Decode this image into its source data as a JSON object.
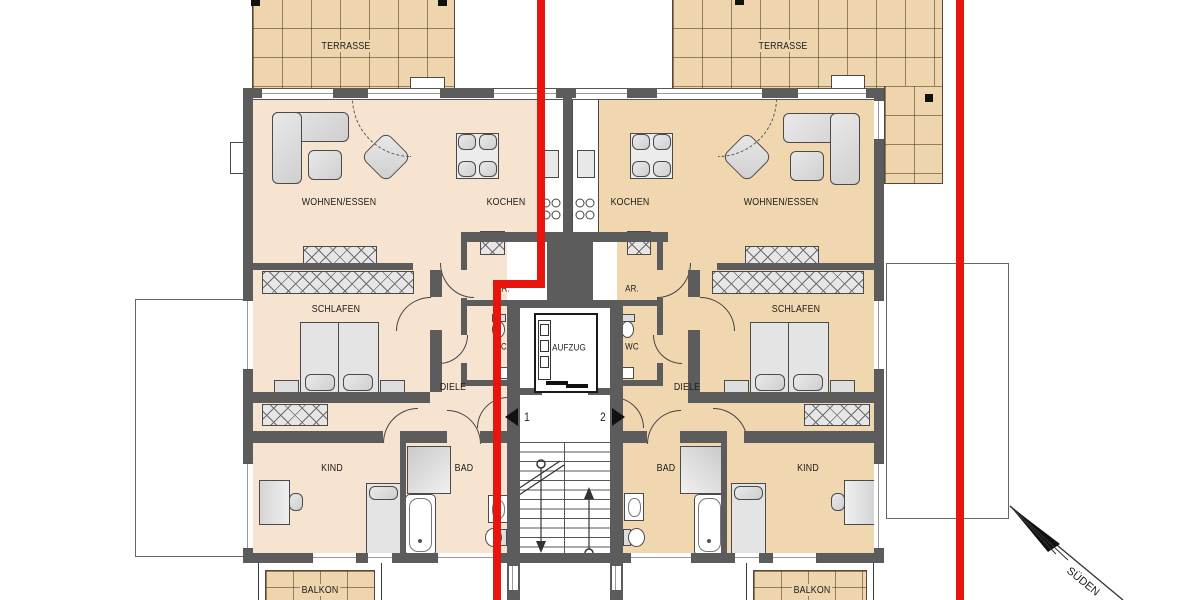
{
  "plan": {
    "type": "residential floor plan, two mirrored apartments with shared stair/elevator core",
    "orientation_arrow": "SÜDEN",
    "section_lines": {
      "count": 2,
      "color": "#e8150f"
    },
    "colors": {
      "left_unit_floor": "#f7e4d0",
      "right_unit_floor": "#f0d7af",
      "terrace_tile": "#eed5ae",
      "wall": "#5c5c5c",
      "section_line_red": "#e8150f",
      "background": "#ffffff"
    },
    "apartments": [
      {
        "marker": "1",
        "rooms": [
          "WOHNEN/ESSEN",
          "KOCHEN",
          "SCHLAFEN",
          "KIND",
          "BAD",
          "WC",
          "AR.",
          "DIELE"
        ],
        "outdoor": [
          "TERRASSE",
          "BALKON"
        ]
      },
      {
        "marker": "2",
        "rooms": [
          "WOHNEN/ESSEN",
          "KOCHEN",
          "SCHLAFEN",
          "KIND",
          "BAD",
          "WC",
          "AR.",
          "DIELE"
        ],
        "outdoor": [
          "TERRASSE",
          "BALKON"
        ]
      }
    ],
    "shared": [
      "AUFZUG",
      "stairwell"
    ]
  },
  "labels": {
    "terrasse_left": "TERRASSE",
    "terrasse_right": "TERRASSE",
    "wohnen_left": "WOHNEN/ESSEN",
    "wohnen_right": "WOHNEN/ESSEN",
    "kochen_left": "KOCHEN",
    "kochen_right": "KOCHEN",
    "schlafen_left": "SCHLAFEN",
    "schlafen_right": "SCHLAFEN",
    "ar_left": "AR.",
    "ar_right": "AR.",
    "wc_left": "WC",
    "wc_right": "WC",
    "aufzug": "AUFZUG",
    "diele_left": "DIELE",
    "diele_right": "DIELE",
    "kind_left": "KIND",
    "kind_right": "KIND",
    "bad_left": "BAD",
    "bad_right": "BAD",
    "balkon_left": "BALKON",
    "balkon_right": "BALKON",
    "unit_left": "1",
    "unit_right": "2",
    "sueden": "SÜDEN"
  }
}
